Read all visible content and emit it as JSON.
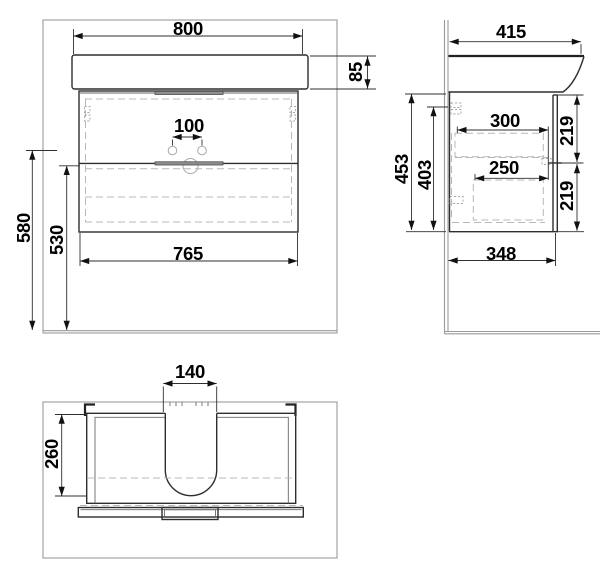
{
  "front": {
    "sink_width": "800",
    "sink_height": "85",
    "faucet_hole_spacing": "100",
    "overall_height": "580",
    "cabinet_height": "530",
    "cabinet_width": "765"
  },
  "side": {
    "sink_depth": "415",
    "top_drawer_depth": "300",
    "bottom_drawer_depth": "250",
    "cabinet_height": "453",
    "cabinet_inner_height": "403",
    "top_drawer_front_height": "219",
    "bottom_drawer_front_height": "219",
    "cabinet_depth": "348"
  },
  "top": {
    "siphon_cutout_width": "140",
    "drawer_inner_depth": "260"
  },
  "colors": {
    "line": "#2e2e2e",
    "frame": "#9a9a9a",
    "dashed": "#b8b8b8",
    "hardware": "#8f8f8f",
    "text": "#000000",
    "background": "#ffffff"
  }
}
